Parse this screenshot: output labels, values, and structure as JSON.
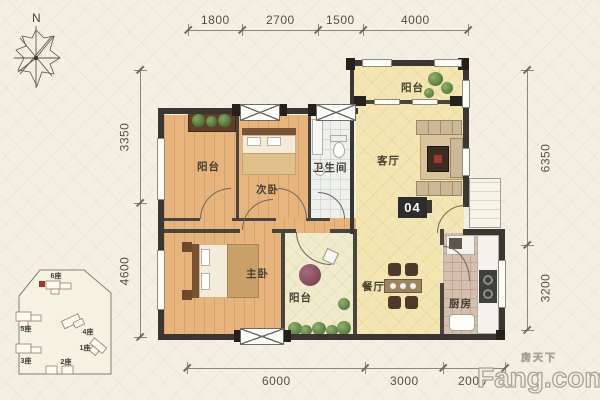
{
  "compass": {
    "label": "N"
  },
  "dimensions": {
    "top": [
      "1800",
      "2700",
      "1500",
      "4000"
    ],
    "left": [
      "3350",
      "4600"
    ],
    "right": [
      "6350",
      "3200"
    ],
    "bottom": [
      "6000",
      "3000",
      "2000"
    ]
  },
  "rooms": {
    "balcony_top_left": "阳台",
    "bedroom2": "次卧",
    "bathroom": "卫生间",
    "living": "客厅",
    "balcony_top_right": "阳台",
    "master_bedroom": "主卧",
    "balcony_bottom": "阳台",
    "dining": "餐厅",
    "kitchen": "厨房"
  },
  "unit_badge": "04",
  "site_plan": {
    "buildings": [
      "6座",
      "5座",
      "4座",
      "1座",
      "3座",
      "2座"
    ]
  },
  "watermark": {
    "cn": "房天下",
    "brand": "Fang.com"
  },
  "colors": {
    "wall": "#3a3632",
    "wood_floor": "#e6b47c",
    "pale_floor": "#f3e6b2",
    "marker_red": "#a83232"
  }
}
